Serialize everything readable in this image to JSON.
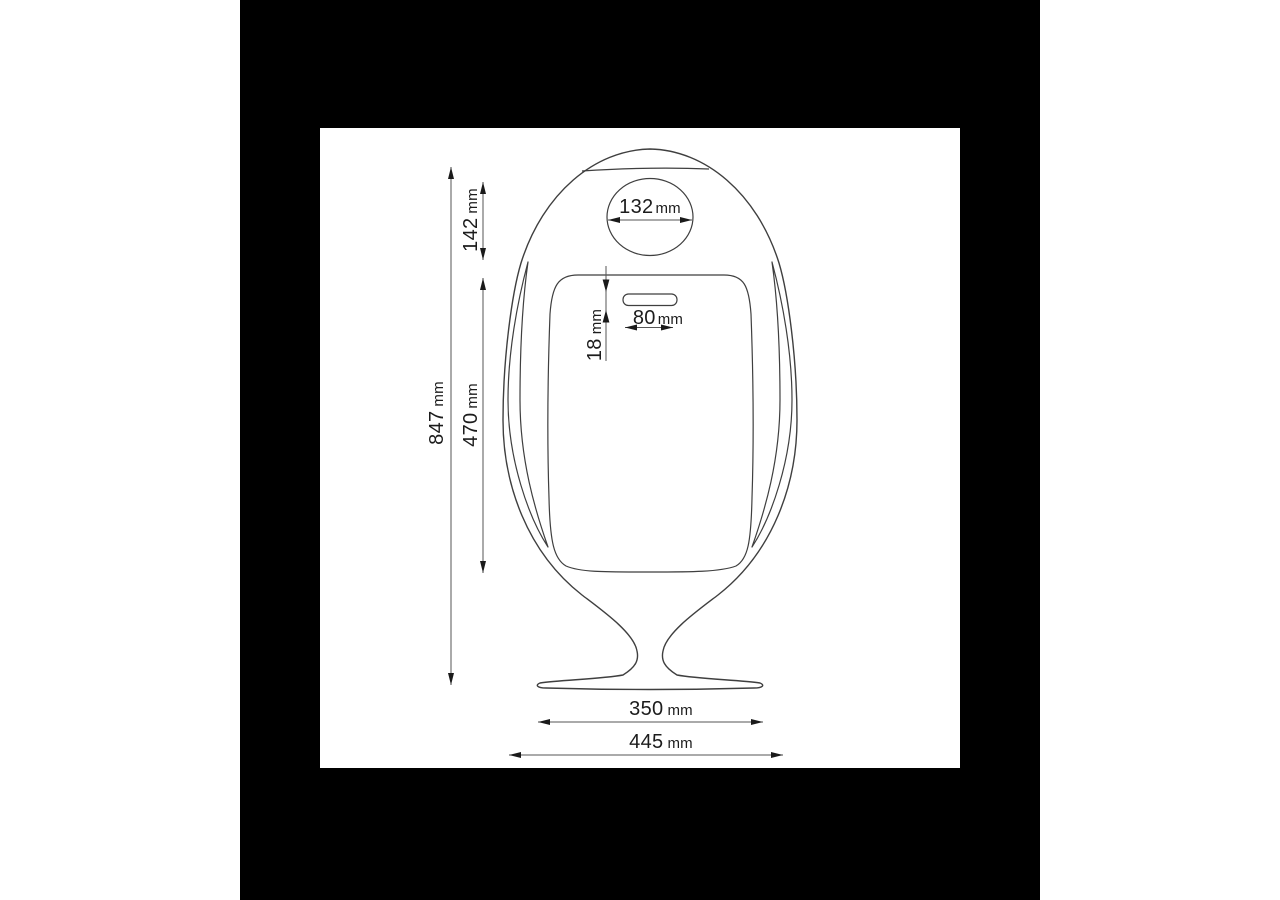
{
  "colors": {
    "page-bg": "#ffffff",
    "panel-bg": "#000000",
    "canvas-bg": "#ffffff",
    "outline": "#3f3f3f",
    "dim-line": "#565656",
    "arrow": "#1a1a1a",
    "text": "#1c1c1c"
  },
  "dimensions": {
    "overall_height": {
      "value": "847",
      "unit": "mm"
    },
    "lid_section_height": {
      "value": "142",
      "unit": "mm"
    },
    "door_height": {
      "value": "470",
      "unit": "mm"
    },
    "slot_inset": {
      "value": "18",
      "unit": "mm"
    },
    "lid_opening_diameter": {
      "value": "132",
      "unit": "mm"
    },
    "slot_width": {
      "value": "80",
      "unit": "mm"
    },
    "base_width": {
      "value": "350",
      "unit": "mm"
    },
    "overall_width": {
      "value": "445",
      "unit": "mm"
    }
  }
}
